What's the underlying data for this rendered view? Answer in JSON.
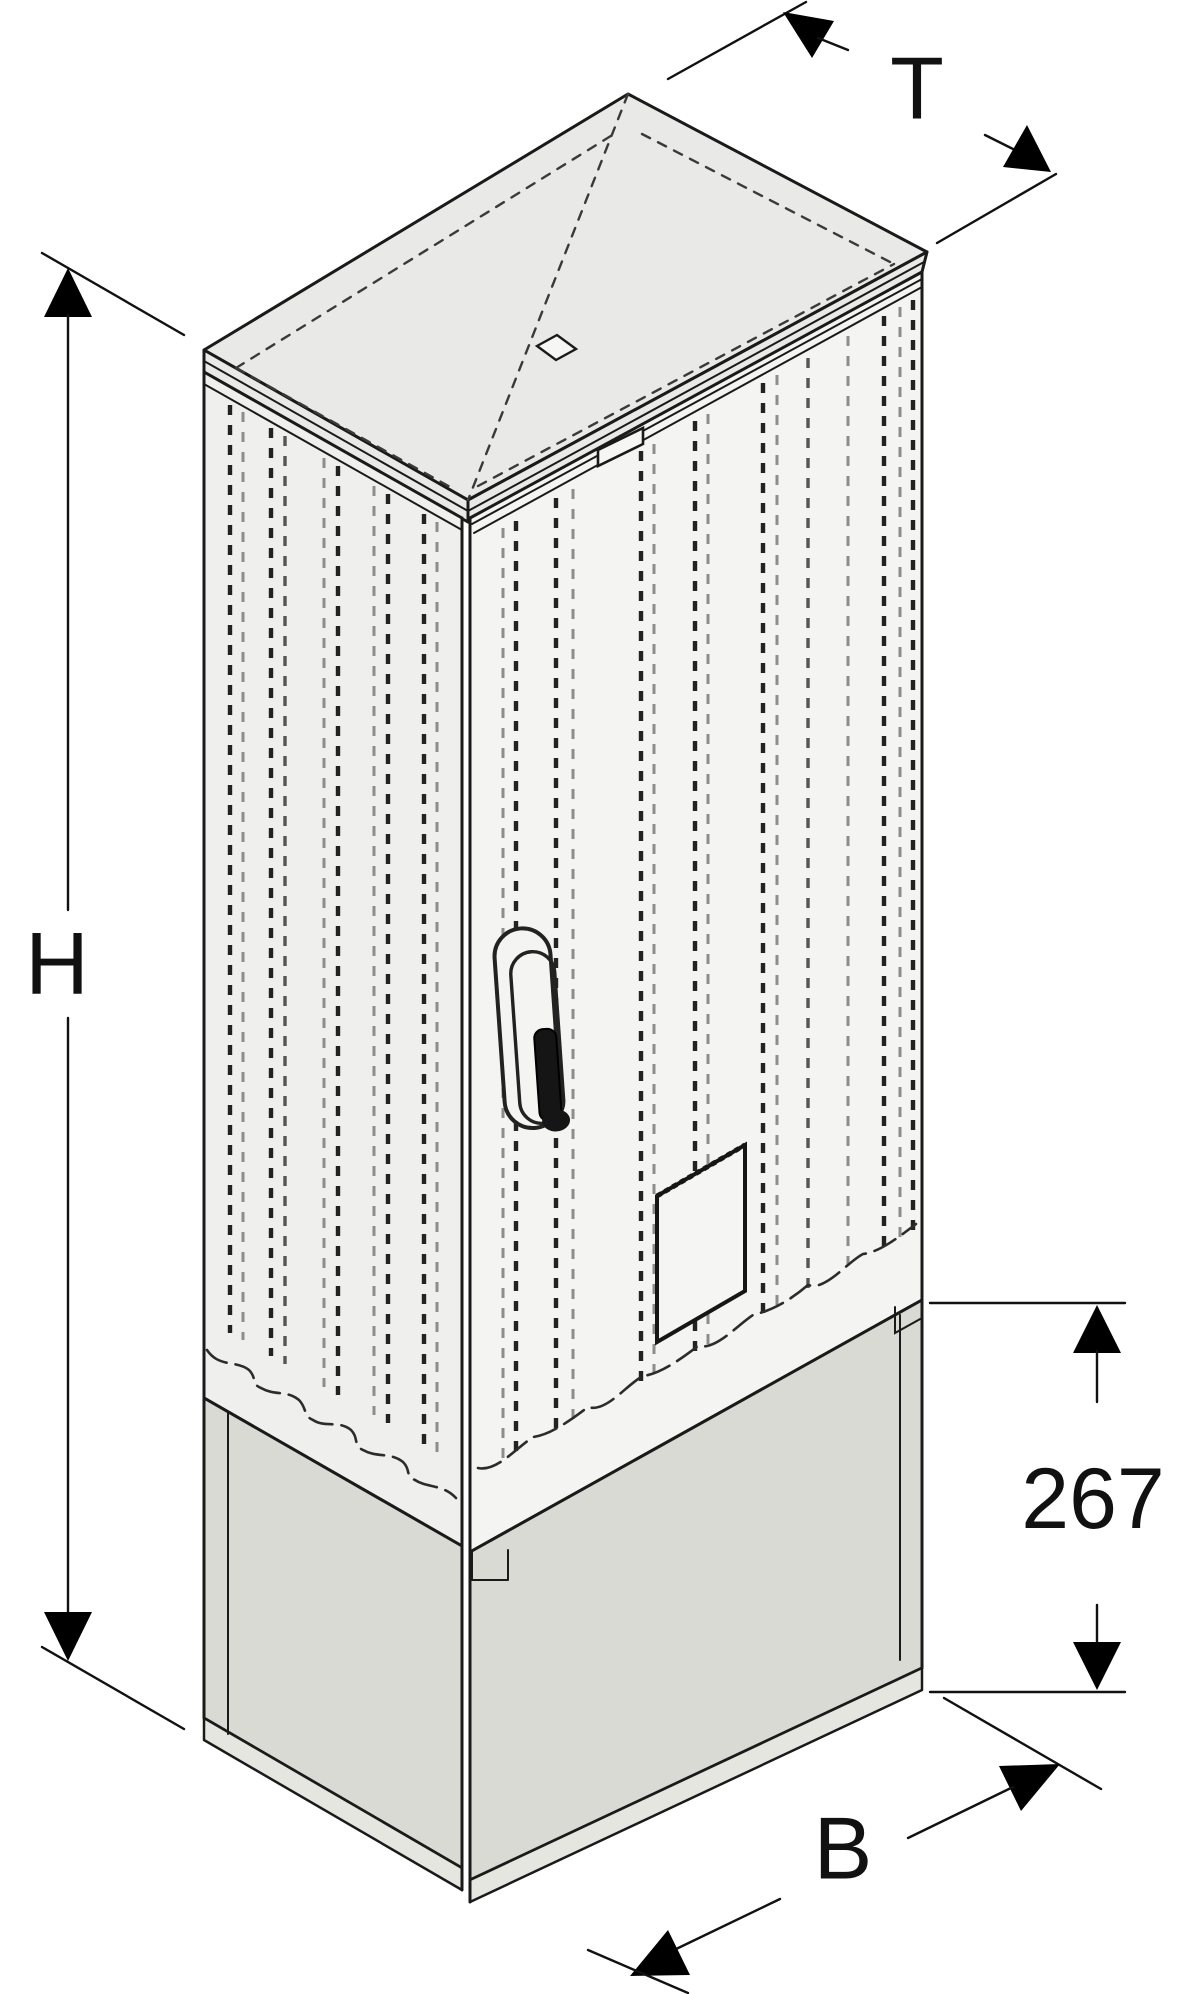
{
  "figure": {
    "description": "Isometric line drawing of an outdoor electrical enclosure on a plinth base, with dimension callouts"
  },
  "labels": {
    "depth": "T",
    "height": "H",
    "width": "B",
    "plinth_height": "267"
  },
  "colors": {
    "background": "#ffffff",
    "line": "#1a1a1a",
    "roof_fill": "#e9eae7",
    "side_fill": "#eff0ee",
    "front_fill": "#f4f4f2",
    "plinth_fill": "#d9dad4",
    "base_strip_fill": "#e6e6e1"
  }
}
